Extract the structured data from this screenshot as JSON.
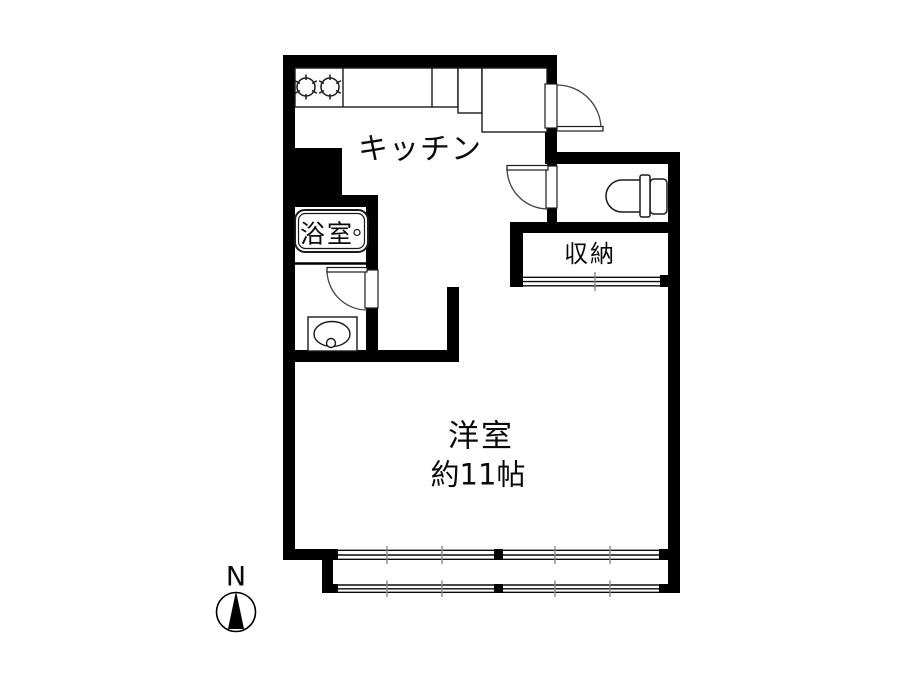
{
  "floor_plan": {
    "type": "apartment-floor-plan",
    "bg_color": "#ffffff",
    "wall_color": "#000000",
    "line_color": "#1a1a1a",
    "arc_color": "#444444",
    "tick_color": "#888888",
    "labels": {
      "kitchen": "キッチン",
      "bathroom": "浴室",
      "storage": "収納",
      "main_room": "洋室",
      "main_room_size": "約11帖",
      "compass_north": "N"
    },
    "fixtures": [
      "gas-stove-2-burner-icon",
      "kitchen-counter-icon",
      "refrigerator-space-icon",
      "bathtub-icon",
      "washbasin-icon",
      "toilet-icon",
      "entrance-swing-door-icon",
      "toilet-swing-door-icon",
      "washroom-swing-door-icon",
      "closet-sliding-door-icon",
      "sliding-window-icon",
      "north-compass-icon"
    ]
  }
}
